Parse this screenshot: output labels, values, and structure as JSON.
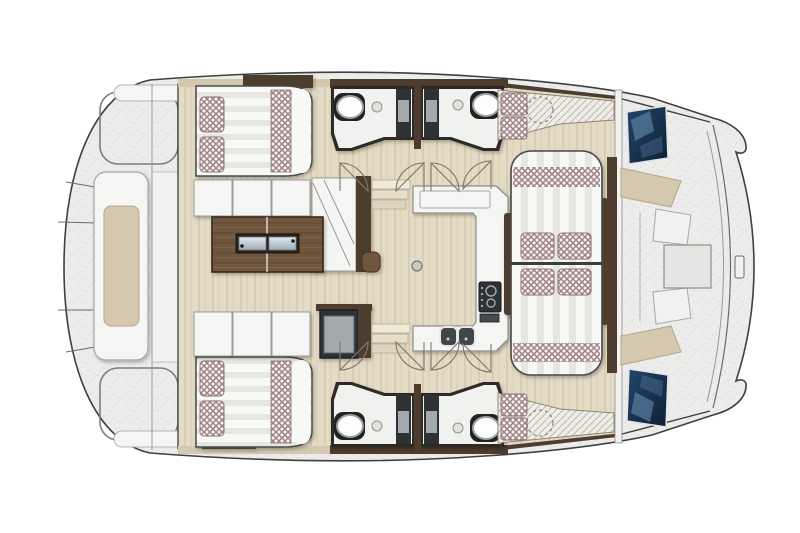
{
  "figure": {
    "title": "Catamaran interior deck floor plan, top-down view, bow to the right",
    "description": "Schematic layout plan of a sailing catamaran saloon deck: two double berths aft (port and starboard), two bathrooms with wash basins and shower columns, central saloon with L-shaped sofa and folding wood table, U-shaped galley with stove and double sink, convertible dinette with lattice cushions, forward cockpit with benches and table between the two bow tips, aft platform with sun pad."
  },
  "rooms": {
    "port_berth": {
      "label": "Port double berth",
      "pillows": 2,
      "lattice_bolster": 1
    },
    "starboard_berth": {
      "label": "Starboard double berth",
      "pillows": 2,
      "lattice_bolster": 1
    },
    "port_head": {
      "label": "Port bathroom",
      "fixtures": [
        "wash basin",
        "shower column",
        "door swing"
      ]
    },
    "starboard_head": {
      "label": "Starboard bathroom",
      "fixtures": [
        "wash basin",
        "shower column",
        "door swing"
      ]
    },
    "saloon": {
      "label": "Saloon",
      "furniture": [
        "L-shaped sofa",
        "folding wood table with metal hinges",
        "storage module"
      ]
    },
    "galley": {
      "label": "Galley",
      "furniture": [
        "U-shaped counter",
        "two-burner stove",
        "double sink",
        "floor fitting"
      ]
    },
    "dinette": {
      "label": "Convertible dinette berth",
      "cushions": 4,
      "lattice_bands": 2
    },
    "window_seats": {
      "label": "Forward window seats",
      "cushions_each": 2
    },
    "forward_cockpit": {
      "label": "Forward cockpit",
      "furniture": [
        "two backrests",
        "two benches",
        "center table"
      ],
      "windows": 2
    },
    "aft_deck": {
      "label": "Aft deck",
      "furniture": [
        "sun pad platform",
        "two transom hatches",
        "two seat pads"
      ]
    },
    "companionways": {
      "label": "Hull companionway steps",
      "count": 2,
      "treads_each": 3
    }
  },
  "inventory": {
    "beds": 3,
    "bathrooms": 2,
    "sinks_bathroom": 2,
    "door_swings": 8,
    "hull_bows": 2,
    "hull_windows": 2,
    "lattice_cushions_total": 12
  },
  "colors": {
    "outline": "#3f3f3f",
    "deck": "#ececea",
    "deck_speckle": "#d8d8d5",
    "floor_wood": "#e3dbc5",
    "floor_wood_grain": "#d7cdb3",
    "table_wood": "#6f563c",
    "table_wood_dark": "#5c4631",
    "wall_brown": "#4e3d2e",
    "trim_beige": "#d4c8af",
    "furniture_white": "#f5f5f3",
    "panel_white": "#f1f1ef",
    "line_gray": "#9a9a98",
    "cushion_lattice": "#a08385",
    "cushion_base": "#f7f4f3",
    "mattress_stripe": "#e6e6e3",
    "mattress_base": "#f8f8f6",
    "appliance_dark": "#2f3336",
    "appliance_inner": "#a3aaae",
    "window_blue_dark": "#24466b",
    "window_blue_deep": "#0d2034",
    "window_reflection": "#6e93b8",
    "metal_light": "#e2e9ed",
    "metal_dark": "#9fadb6",
    "sink_ring": "#9aa2a8",
    "door_arc": "#80776a",
    "bench_hatch": "#b9b2a4"
  }
}
